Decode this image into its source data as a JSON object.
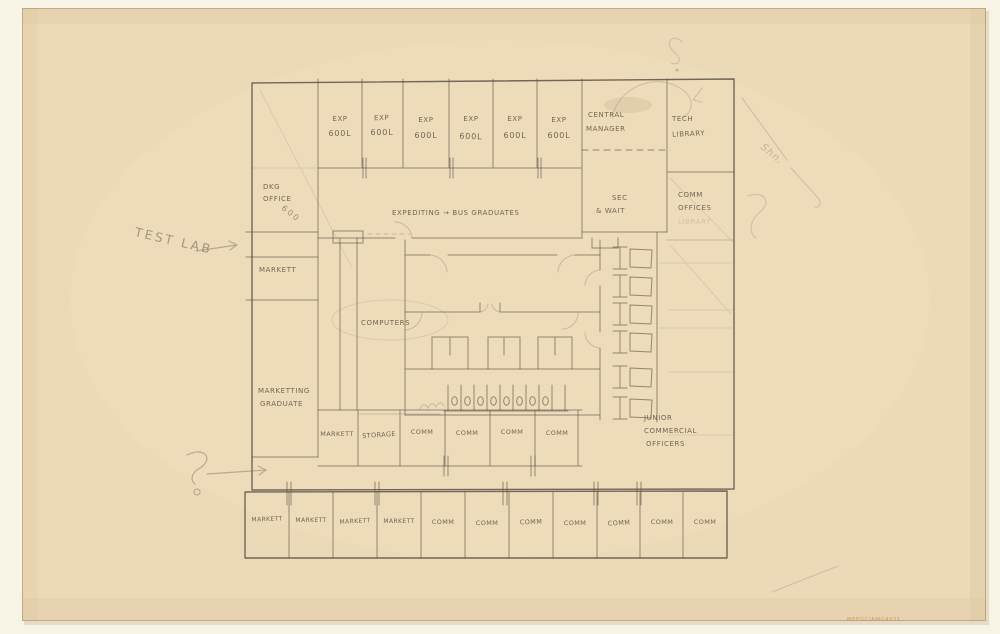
{
  "colors": {
    "paper": "#ecd9b8",
    "mat_background": "#f7f3e5",
    "pencil_dark": "#4e463c",
    "pencil_light": "#968a77",
    "stamp_orange": "#c98e52"
  },
  "plan": {
    "top_row": {
      "exp_cells": [
        {
          "line1": "EXP",
          "line2": "600L"
        },
        {
          "line1": "EXP",
          "line2": "600L"
        },
        {
          "line1": "EXP",
          "line2": "600L"
        },
        {
          "line1": "EXP",
          "line2": "600L"
        },
        {
          "line1": "EXP",
          "line2": "600L"
        },
        {
          "line1": "EXP",
          "line2": "600L"
        }
      ],
      "central_manager": {
        "line1": "CENTRAL",
        "line2": "MANAGER"
      },
      "tech_library": {
        "line1": "TECH",
        "line2": "LIBRARY"
      }
    },
    "left_column": {
      "dkg_office": {
        "line1": "DKG",
        "line2": "OFFICE",
        "area": "600"
      },
      "markett_label": "MARKETT",
      "marketing_graduate": {
        "line1": "MARKETTING",
        "line2": "GRADUATE"
      }
    },
    "hall_label": "EXPEDITING → BUS GRADUATES",
    "sec_wait": {
      "line1": "SEC",
      "line2": "& WAIT"
    },
    "comm_offices": {
      "line1": "COMM",
      "line2": "OFFICES",
      "erased_label": "LIBRARY"
    },
    "computers_label": "COMPUTERS",
    "lower_row_cells": [
      "MARKETT",
      "STORAGE",
      "COMM",
      "COMM",
      "COMM",
      "COMM"
    ],
    "junior_offices": {
      "line1": "JUNIOR",
      "line2": "COMMERCIAL",
      "line3": "OFFICERS"
    },
    "bottom_strip_cells": [
      "MARKETT",
      "MARKETT",
      "MARKETT",
      "MARKETT",
      "COMM",
      "COMM",
      "COMM",
      "COMM",
      "COMM",
      "COMM",
      "COMM"
    ]
  },
  "annotations": {
    "test_lab": "TEST LAB",
    "cursive_note": "Shn.",
    "catalog_stamp": "MEEGC/AMG4931"
  }
}
